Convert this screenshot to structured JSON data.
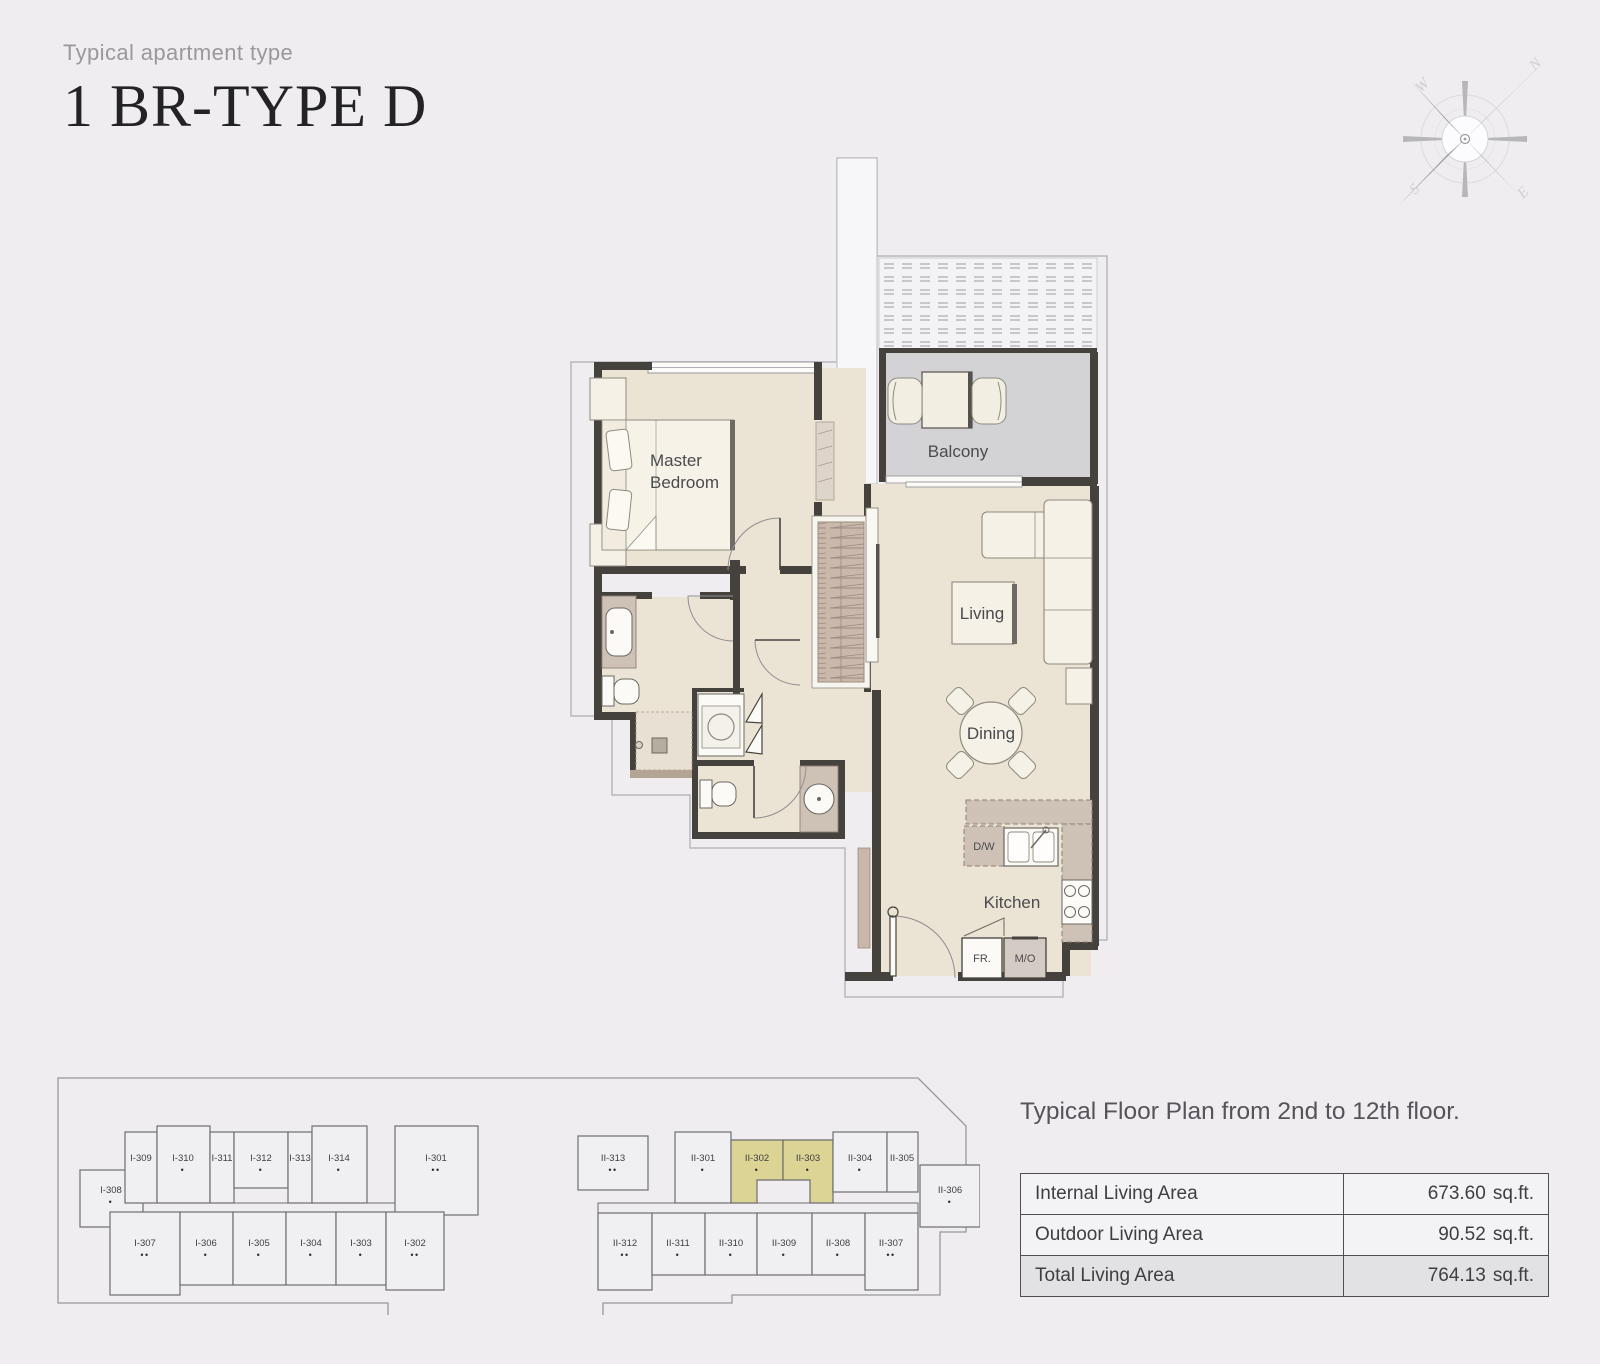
{
  "header": {
    "subtitle": "Typical apartment type",
    "title": "1 BR-TYPE D"
  },
  "compass": {
    "n": "N",
    "s": "S",
    "e": "E",
    "w": "W"
  },
  "floor_plan": {
    "rooms": {
      "master_bedroom_line1": "Master",
      "master_bedroom_line2": "Bedroom",
      "balcony": "Balcony",
      "living": "Living",
      "dining": "Dining",
      "kitchen": "Kitchen"
    },
    "appliances": {
      "dw": "D/W",
      "fr": "FR.",
      "mo": "M/O"
    },
    "colors": {
      "floor": "#ebe4d4",
      "balcony_floor": "#d3d2d5",
      "counter": "#cec2b6",
      "wardrobe": "#cab8ac",
      "wall": "#45423e",
      "outline": "#b9b8bc"
    }
  },
  "site_plan": {
    "highlight_color": "#dcd494",
    "highlighted_units": [
      "II-302",
      "II-303"
    ],
    "building1": {
      "units": [
        {
          "label": "I-308",
          "dots": "•"
        },
        {
          "label": "I-309",
          "dots": ""
        },
        {
          "label": "I-310",
          "dots": "•"
        },
        {
          "label": "I-311",
          "dots": ""
        },
        {
          "label": "I-312",
          "dots": "•"
        },
        {
          "label": "I-313",
          "dots": ""
        },
        {
          "label": "I-314",
          "dots": "•"
        },
        {
          "label": "I-301",
          "dots": "••"
        },
        {
          "label": "I-307",
          "dots": "••"
        },
        {
          "label": "I-306",
          "dots": "•"
        },
        {
          "label": "I-305",
          "dots": "•"
        },
        {
          "label": "I-304",
          "dots": "•"
        },
        {
          "label": "I-303",
          "dots": "•"
        },
        {
          "label": "I-302",
          "dots": "••"
        }
      ]
    },
    "building2": {
      "units": [
        {
          "label": "II-313",
          "dots": "••"
        },
        {
          "label": "II-301",
          "dots": "•"
        },
        {
          "label": "II-302",
          "dots": "•"
        },
        {
          "label": "II-303",
          "dots": "•"
        },
        {
          "label": "II-304",
          "dots": "•"
        },
        {
          "label": "II-305",
          "dots": ""
        },
        {
          "label": "II-306",
          "dots": "•"
        },
        {
          "label": "II-312",
          "dots": "••"
        },
        {
          "label": "II-311",
          "dots": "•"
        },
        {
          "label": "II-310",
          "dots": "•"
        },
        {
          "label": "II-309",
          "dots": "•"
        },
        {
          "label": "II-308",
          "dots": "•"
        },
        {
          "label": "II-307",
          "dots": "••"
        }
      ]
    }
  },
  "summary": {
    "caption": "Typical Floor Plan from 2nd to 12th floor.",
    "rows": [
      {
        "label": "Internal Living Area",
        "value": "673.60",
        "unit": "sq.ft."
      },
      {
        "label": "Outdoor Living Area",
        "value": "90.52",
        "unit": "sq.ft."
      },
      {
        "label": "Total Living Area",
        "value": "764.13",
        "unit": "sq.ft."
      }
    ]
  }
}
